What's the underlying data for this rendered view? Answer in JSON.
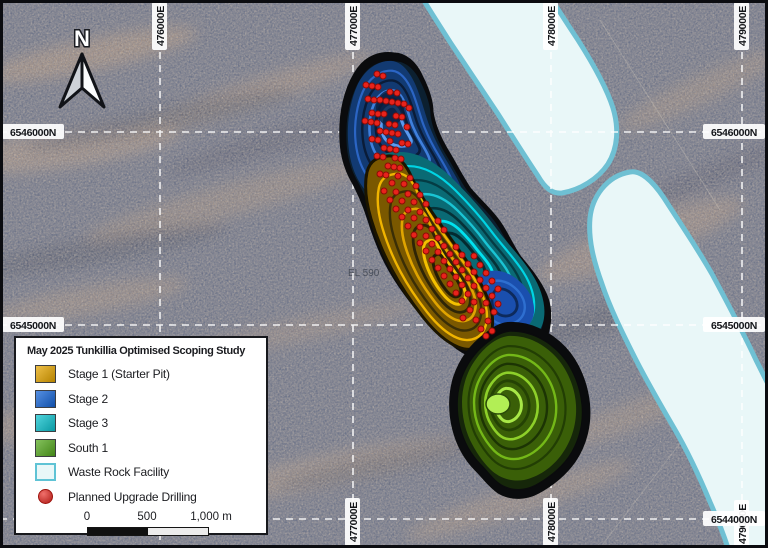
{
  "map": {
    "north_label": "N",
    "tenement_label": "EL 590",
    "grid": {
      "top_eastings": [
        "476000E",
        "477000E",
        "478000E",
        "479000E"
      ],
      "bottom_eastings": [
        "477000E",
        "478000E",
        "479000E"
      ],
      "left_northings": [
        "6546000N",
        "6545000N"
      ],
      "right_northings": [
        "6546000N",
        "6545000N",
        "6544000N"
      ]
    },
    "colors": {
      "stage1_gold": "#e8a700",
      "stage2_blue": "#1565d8",
      "stage3_cyan": "#0cc4d0",
      "south1_green": "#55aa1e",
      "waste_rock_fill": "#e9f7f8",
      "waste_rock_border": "#6fc0d3",
      "drill_dot_red": "#e8231c"
    },
    "drill_dots": [
      [
        377,
        74
      ],
      [
        383,
        76
      ],
      [
        366,
        85
      ],
      [
        372,
        86
      ],
      [
        378,
        87
      ],
      [
        390,
        92
      ],
      [
        397,
        93
      ],
      [
        368,
        99
      ],
      [
        374,
        100
      ],
      [
        380,
        100
      ],
      [
        386,
        101
      ],
      [
        392,
        102
      ],
      [
        398,
        103
      ],
      [
        404,
        104
      ],
      [
        409,
        108
      ],
      [
        372,
        113
      ],
      [
        378,
        114
      ],
      [
        384,
        114
      ],
      [
        396,
        116
      ],
      [
        402,
        117
      ],
      [
        365,
        121
      ],
      [
        371,
        122
      ],
      [
        377,
        123
      ],
      [
        389,
        124
      ],
      [
        395,
        125
      ],
      [
        407,
        127
      ],
      [
        380,
        131
      ],
      [
        386,
        132
      ],
      [
        392,
        133
      ],
      [
        398,
        134
      ],
      [
        372,
        139
      ],
      [
        378,
        140
      ],
      [
        390,
        141
      ],
      [
        402,
        143
      ],
      [
        408,
        144
      ],
      [
        384,
        148
      ],
      [
        390,
        149
      ],
      [
        396,
        150
      ],
      [
        377,
        156
      ],
      [
        383,
        157
      ],
      [
        395,
        158
      ],
      [
        401,
        159
      ],
      [
        388,
        166
      ],
      [
        394,
        167
      ],
      [
        400,
        168
      ],
      [
        380,
        174
      ],
      [
        386,
        175
      ],
      [
        398,
        176
      ],
      [
        410,
        178
      ],
      [
        392,
        183
      ],
      [
        404,
        184
      ],
      [
        416,
        186
      ],
      [
        384,
        191
      ],
      [
        396,
        192
      ],
      [
        408,
        194
      ],
      [
        420,
        195
      ],
      [
        390,
        200
      ],
      [
        402,
        201
      ],
      [
        414,
        202
      ],
      [
        426,
        204
      ],
      [
        396,
        209
      ],
      [
        408,
        210
      ],
      [
        420,
        212
      ],
      [
        402,
        217
      ],
      [
        414,
        218
      ],
      [
        426,
        220
      ],
      [
        438,
        221
      ],
      [
        408,
        226
      ],
      [
        420,
        227
      ],
      [
        432,
        229
      ],
      [
        444,
        230
      ],
      [
        414,
        235
      ],
      [
        426,
        236
      ],
      [
        438,
        238
      ],
      [
        420,
        243
      ],
      [
        432,
        244
      ],
      [
        444,
        246
      ],
      [
        456,
        247
      ],
      [
        426,
        251
      ],
      [
        438,
        252
      ],
      [
        450,
        254
      ],
      [
        462,
        255
      ],
      [
        474,
        256
      ],
      [
        432,
        260
      ],
      [
        444,
        261
      ],
      [
        456,
        262
      ],
      [
        468,
        264
      ],
      [
        480,
        265
      ],
      [
        438,
        268
      ],
      [
        450,
        269
      ],
      [
        462,
        270
      ],
      [
        474,
        272
      ],
      [
        486,
        273
      ],
      [
        444,
        276
      ],
      [
        456,
        277
      ],
      [
        468,
        278
      ],
      [
        480,
        280
      ],
      [
        492,
        281
      ],
      [
        450,
        284
      ],
      [
        462,
        285
      ],
      [
        474,
        286
      ],
      [
        486,
        288
      ],
      [
        498,
        289
      ],
      [
        456,
        293
      ],
      [
        468,
        294
      ],
      [
        480,
        295
      ],
      [
        492,
        296
      ],
      [
        462,
        301
      ],
      [
        474,
        302
      ],
      [
        486,
        303
      ],
      [
        498,
        304
      ],
      [
        470,
        310
      ],
      [
        482,
        311
      ],
      [
        494,
        312
      ],
      [
        463,
        318
      ],
      [
        476,
        320
      ],
      [
        488,
        321
      ],
      [
        481,
        329
      ],
      [
        492,
        331
      ],
      [
        486,
        336
      ]
    ]
  },
  "legend": {
    "title": "May 2025 Tunkillia Optimised Scoping Study",
    "items": [
      {
        "label": "Stage 1 (Starter Pit)",
        "color": "#e8a700",
        "swatch": "square"
      },
      {
        "label": "Stage 2",
        "color": "#1565d8",
        "swatch": "square"
      },
      {
        "label": "Stage 3",
        "color": "#0cc4d0",
        "swatch": "square"
      },
      {
        "label": "South 1",
        "color": "#55aa1e",
        "swatch": "square"
      },
      {
        "label": "Waste Rock Facility",
        "color": "#e9f7f8",
        "swatch": "square-outline"
      },
      {
        "label": "Planned Upgrade Drilling",
        "color": "#e8231c",
        "swatch": "circle"
      }
    ],
    "scalebar": {
      "ticks": [
        "0",
        "500",
        "1,000 m"
      ]
    }
  }
}
